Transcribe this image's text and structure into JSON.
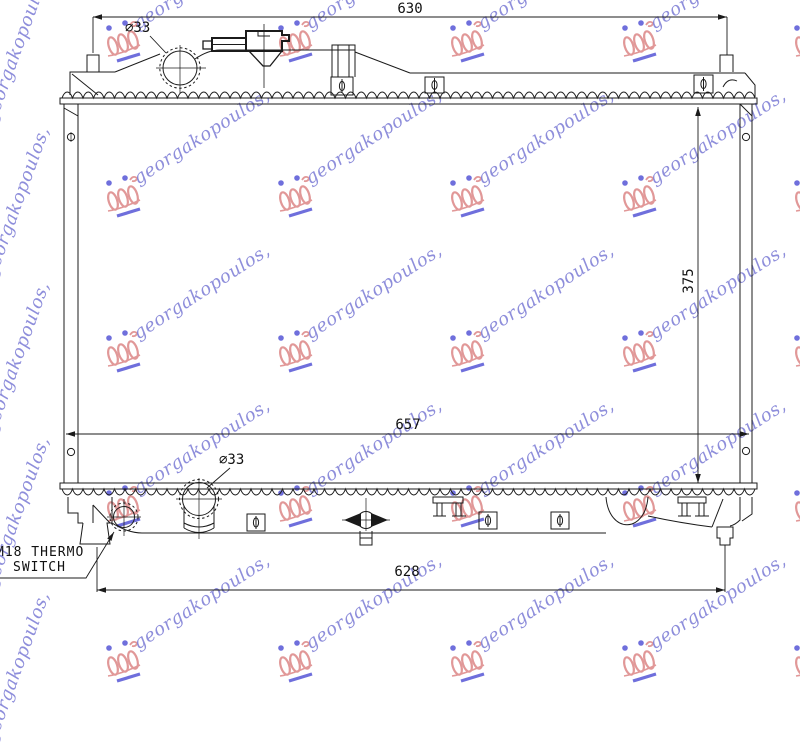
{
  "drawing": {
    "type": "radiator-technical-line-drawing",
    "line_color": "#1b1b1b"
  },
  "dimensions": {
    "top_width": "630",
    "core_height": "375",
    "core_width": "657",
    "bottom_width": "628",
    "filler_neck_top_diameter": "⌀33",
    "filler_neck_bottom_diameter": "⌀33"
  },
  "labels": {
    "thermo_switch_line1": "M18 THERMO",
    "thermo_switch_line2": "SWITCH"
  },
  "watermark": {
    "text": "georgakopoulos,",
    "text_color": "#8585d8",
    "logo_color": "#dd8a8a",
    "accent_color": "#5c5cd8"
  }
}
